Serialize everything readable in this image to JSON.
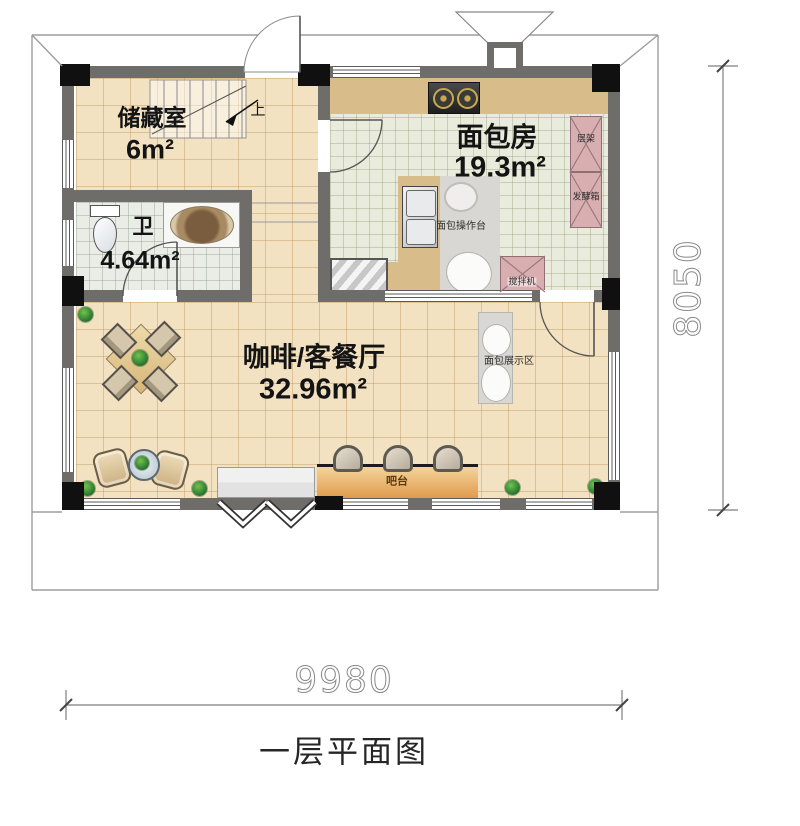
{
  "title": "一层平面图",
  "dimensions": {
    "width": "9980",
    "height": "8050"
  },
  "rooms": [
    {
      "name": "储藏室",
      "area": "6m²"
    },
    {
      "name": "卫",
      "area": "4.64m²"
    },
    {
      "name": "面包房",
      "area": "19.3m²"
    },
    {
      "name": "咖啡/客餐厅",
      "area": "32.96m²"
    }
  ],
  "annotations": {
    "stairs_up": "上",
    "shelf_rack": "层架",
    "proofing_box": "发酵箱",
    "bread_worktable": "面包操作台",
    "mixer": "搅拌机",
    "bread_display": "面包展示区",
    "bar_counter": "吧台"
  }
}
